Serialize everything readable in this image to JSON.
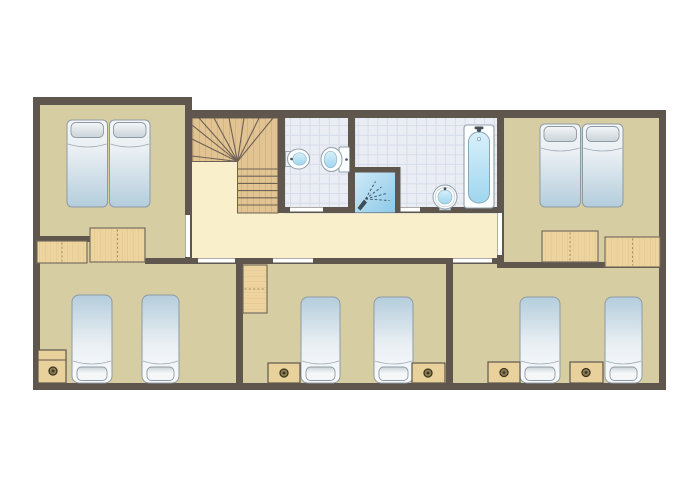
{
  "meta": {
    "kind": "floor-plan",
    "canvas": {
      "w": 700,
      "h": 500
    }
  },
  "colors": {
    "bg": "#ffffff",
    "wall": "#5f574e",
    "floor_tan": "#d6cda3",
    "floor_cream": "#f9f0cb",
    "tile": "#eaedf4",
    "tile_grid": "#d6dce9",
    "tile_edge": "#c4cbda",
    "wood": "#eed5a0",
    "wood_grain": "#d9b87c",
    "wood_stroke": "#6f655a",
    "wood_dash": "#a38b58",
    "stair_wood": "#e2c492",
    "stair_line": "#6e6156",
    "bed_stroke": "#8f9aa4",
    "mattress_blue": "#b4cddc",
    "mattress_mid": "#e9eff3",
    "mattress_light": "#fafcfd",
    "pillow_light": "#f4f6f8",
    "pillow_dark": "#c9d3d9",
    "fixture_stroke": "#93a0ab",
    "fixture_fill": "#fdfefe",
    "fixture_inner_stroke": "#8fb7cc",
    "blue_light": "#d9f0fa",
    "blue_dark": "#9fd6ee",
    "shower_light": "#cfeaf8",
    "shower_dark": "#8bc9e8",
    "spray": "#3d4d59",
    "metal": "#454f58",
    "nightstand": "#e9d19c",
    "knob_ring": "#8a7c50",
    "knob_dark": "#3c3524",
    "door_gap": "#ffffff"
  },
  "floors": [
    {
      "name": "bedroom-top-left-floor",
      "kind": "tan",
      "x": 40,
      "y": 104,
      "w": 152,
      "h": 160
    },
    {
      "name": "landing-corridor-floor",
      "kind": "cream",
      "x": 192,
      "y": 110,
      "w": 312,
      "h": 154
    },
    {
      "name": "bedroom-top-right-floor",
      "kind": "tan",
      "x": 497,
      "y": 116,
      "w": 162,
      "h": 152
    },
    {
      "name": "bottom-bedrooms-floor",
      "kind": "tan",
      "x": 40,
      "y": 258,
      "w": 619,
      "h": 125
    },
    {
      "name": "wc-floor",
      "kind": "tile",
      "x": 285,
      "y": 116,
      "w": 70,
      "h": 97
    },
    {
      "name": "bathroom-floor",
      "kind": "tile",
      "x": 355,
      "y": 116,
      "w": 149,
      "h": 97
    }
  ],
  "walls": [
    {
      "name": "outer-wall-top-left",
      "x": 33,
      "y": 97,
      "w": 159,
      "h": 8
    },
    {
      "name": "outer-wall-top-right",
      "x": 185,
      "y": 110,
      "w": 481,
      "h": 8
    },
    {
      "name": "outer-wall-bottom",
      "x": 33,
      "y": 383,
      "w": 633,
      "h": 7
    },
    {
      "name": "outer-wall-left",
      "x": 33,
      "y": 97,
      "w": 7,
      "h": 293
    },
    {
      "name": "outer-wall-right",
      "x": 659,
      "y": 110,
      "w": 7,
      "h": 280
    },
    {
      "name": "wall-bedroomTL-corridor",
      "x": 185,
      "y": 104,
      "w": 7,
      "h": 160
    },
    {
      "name": "wall-stairs-wc",
      "x": 278,
      "y": 116,
      "w": 7,
      "h": 97
    },
    {
      "name": "wall-wc-bathroom",
      "x": 348,
      "y": 116,
      "w": 7,
      "h": 97
    },
    {
      "name": "wall-bathroom-bedroomTR",
      "x": 497,
      "y": 116,
      "w": 7,
      "h": 152
    },
    {
      "name": "wall-bathrooms-bottom",
      "x": 285,
      "y": 207,
      "w": 219,
      "h": 6
    },
    {
      "name": "wall-bedroomTL-bottom",
      "x": 33,
      "y": 236,
      "w": 57,
      "h": 6
    },
    {
      "name": "wall-corridor-bottom",
      "x": 145,
      "y": 258,
      "w": 359,
      "h": 6
    },
    {
      "name": "wall-bedroomTR-bottom",
      "x": 504,
      "y": 262,
      "w": 162,
      "h": 6
    },
    {
      "name": "wall-bottom-divider-left",
      "x": 236,
      "y": 258,
      "w": 7,
      "h": 132
    },
    {
      "name": "wall-bottom-divider-right",
      "x": 446,
      "y": 260,
      "w": 7,
      "h": 130
    }
  ],
  "doors": [
    {
      "name": "door-bedroom-top-left",
      "x": 185.5,
      "y": 215,
      "w": 4.5,
      "h": 42
    },
    {
      "name": "door-bedroom-top-right",
      "x": 497.5,
      "y": 213,
      "w": 4.5,
      "h": 42
    },
    {
      "name": "door-wc",
      "x": 290,
      "y": 207.5,
      "w": 33,
      "h": 4
    },
    {
      "name": "door-bathroom",
      "x": 394,
      "y": 207.5,
      "w": 26,
      "h": 4
    },
    {
      "name": "door-bedroom-bottom-left",
      "x": 198,
      "y": 258.5,
      "w": 37,
      "h": 4
    },
    {
      "name": "door-bedroom-bottom-middle",
      "x": 273,
      "y": 258.5,
      "w": 40,
      "h": 4
    },
    {
      "name": "door-bedroom-bottom-right",
      "x": 453,
      "y": 258.5,
      "w": 39,
      "h": 4
    }
  ],
  "stairs": {
    "name": "staircase",
    "fan": {
      "x": 192,
      "y": 118,
      "w": 86,
      "h": 43.5
    },
    "flight": {
      "x": 237.5,
      "y": 161.5,
      "w": 40.5,
      "h": 51.5
    },
    "center": [
      237.5,
      161.5
    ],
    "rays": [
      [
        192,
        156
      ],
      [
        192,
        139
      ],
      [
        192,
        125
      ],
      [
        199,
        118
      ],
      [
        214,
        118
      ],
      [
        229,
        118
      ],
      [
        244,
        118
      ],
      [
        259,
        118
      ],
      [
        273,
        118
      ]
    ],
    "treads": [
      169,
      176.2,
      183.4,
      190.6,
      197.8,
      205
    ]
  },
  "furniture": [
    {
      "type": "double-bed",
      "name": "double-bed-top-left",
      "x": 67,
      "y": 120,
      "w": 83,
      "h": 87
    },
    {
      "type": "double-bed",
      "name": "double-bed-top-right",
      "x": 540,
      "y": 124,
      "w": 83,
      "h": 83
    },
    {
      "type": "single-bed",
      "name": "single-bed-bottom-left-1",
      "x": 72,
      "y": 295,
      "w": 40,
      "h": 88
    },
    {
      "type": "single-bed",
      "name": "single-bed-bottom-left-2",
      "x": 142,
      "y": 295,
      "w": 37,
      "h": 88
    },
    {
      "type": "single-bed",
      "name": "single-bed-bottom-middle-1",
      "x": 301,
      "y": 297,
      "w": 39,
      "h": 86
    },
    {
      "type": "single-bed",
      "name": "single-bed-bottom-middle-2",
      "x": 374,
      "y": 297,
      "w": 39,
      "h": 86
    },
    {
      "type": "single-bed",
      "name": "single-bed-bottom-right-1",
      "x": 520,
      "y": 297,
      "w": 40,
      "h": 86
    },
    {
      "type": "single-bed",
      "name": "single-bed-bottom-right-2",
      "x": 605,
      "y": 297,
      "w": 37,
      "h": 86
    },
    {
      "type": "wardrobe",
      "name": "wardrobe-top-left-1",
      "x": 37,
      "y": 241,
      "w": 50,
      "h": 22,
      "dir": "v"
    },
    {
      "type": "wardrobe",
      "name": "wardrobe-top-left-2",
      "x": 90,
      "y": 228,
      "w": 55,
      "h": 34,
      "dir": "v"
    },
    {
      "type": "wardrobe",
      "name": "wardrobe-top-right-1",
      "x": 542,
      "y": 231,
      "w": 56,
      "h": 31,
      "dir": "v"
    },
    {
      "type": "wardrobe",
      "name": "wardrobe-top-right-2",
      "x": 605,
      "y": 237,
      "w": 55,
      "h": 30,
      "dir": "v"
    },
    {
      "type": "wardrobe",
      "name": "wardrobe-bottom-middle",
      "x": 243,
      "y": 265,
      "w": 24,
      "h": 48,
      "dir": "h"
    },
    {
      "type": "nightstand",
      "name": "nightstand-bottom-left",
      "x": 38,
      "y": 350,
      "w": 28,
      "h": 33,
      "shelf": 360,
      "knob": [
        53,
        371
      ]
    },
    {
      "type": "nightstand",
      "name": "nightstand-bottom-middle-1",
      "x": 268,
      "y": 363,
      "w": 32,
      "h": 20,
      "knob": [
        284,
        373
      ]
    },
    {
      "type": "nightstand",
      "name": "nightstand-bottom-middle-2",
      "x": 412,
      "y": 363,
      "w": 33,
      "h": 20,
      "knob": [
        428,
        373
      ]
    },
    {
      "type": "nightstand",
      "name": "nightstand-bottom-right-1",
      "x": 488,
      "y": 362,
      "w": 32,
      "h": 21,
      "knob": [
        504,
        372.5
      ]
    },
    {
      "type": "nightstand",
      "name": "nightstand-bottom-right-2",
      "x": 570,
      "y": 362,
      "w": 33,
      "h": 21,
      "knob": [
        586,
        372.5
      ]
    },
    {
      "type": "wall-sink",
      "name": "wc-sink",
      "x": 285.5,
      "y": 149
    },
    {
      "type": "toilet",
      "name": "wc-toilet",
      "x": 339,
      "y": 147
    },
    {
      "type": "shower",
      "name": "shower",
      "x": 355,
      "y": 167
    },
    {
      "type": "round-sink",
      "name": "bathroom-sink",
      "cx": 445,
      "cy": 197
    },
    {
      "type": "bathtub",
      "name": "bathtub",
      "x": 464,
      "y": 125,
      "w": 30,
      "h": 83
    }
  ]
}
